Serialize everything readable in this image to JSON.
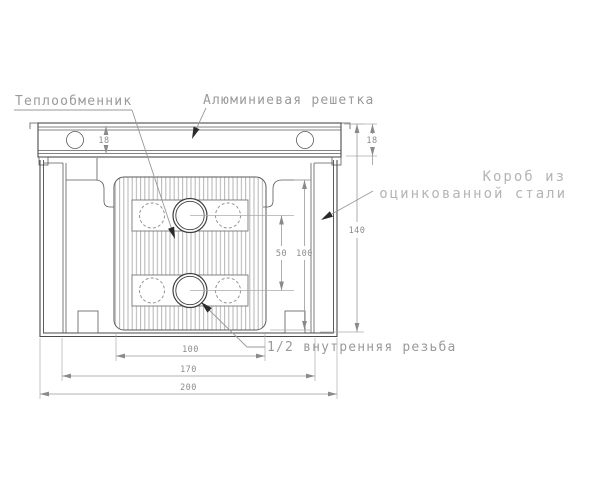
{
  "drawing": {
    "kind": "technical cross-section drawing",
    "language": "Russian"
  },
  "labels": {
    "heat_exchanger": "Теплообменник",
    "aluminium_grille": "Алюминиевая решетка",
    "box_material_line1": "Короб из",
    "box_material_line2": "оцинкованной стали",
    "thread": "1/2 внутренняя резьба"
  },
  "dimensions": {
    "grille_height_left": "18",
    "grille_height_right": "18",
    "pipe_spacing_vertical": "50",
    "exchanger_height": "100",
    "total_height": "140",
    "exchanger_width": "100",
    "inner_width": "170",
    "overall_width": "200"
  },
  "colors": {
    "background": "#ffffff",
    "outline": "#4a4a4a",
    "dimension_lines": "#9a9a9a",
    "label_text": "#9a9a9a",
    "light_label_text": "#b5b5b5",
    "hatch": "#b4b4b4",
    "leader_arrow": "#2b2b2b"
  }
}
